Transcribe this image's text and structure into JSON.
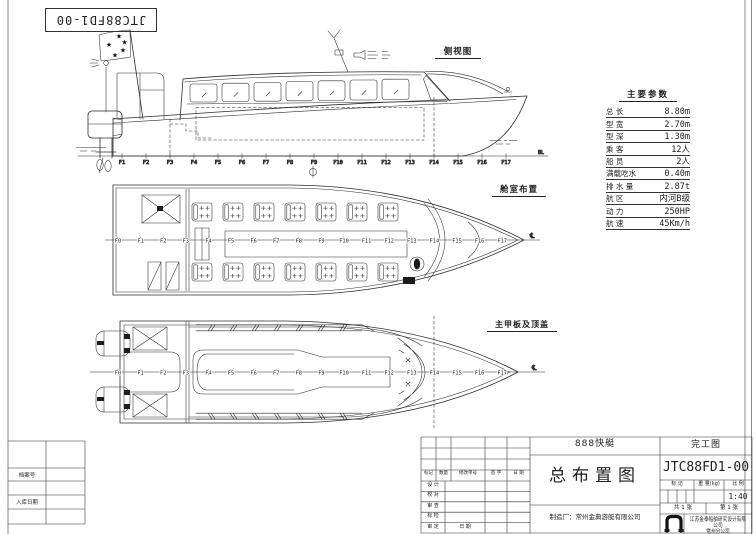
{
  "sheet": {
    "drawing_no_box": "JTC88FD1-00"
  },
  "icons": {
    "flag_star": "★"
  },
  "views": {
    "side_label": "侧视图",
    "cabin_label": "舱室布置",
    "deck_label": "主甲板及顶盖",
    "baseline_mark": "BL",
    "centerline_mark": "℄"
  },
  "frames": {
    "f1_f17": [
      "F1",
      "F2",
      "F3",
      "F4",
      "F5",
      "F6",
      "F7",
      "F8",
      "F9",
      "F10",
      "F11",
      "F12",
      "F13",
      "F14",
      "F15",
      "F16",
      "F17"
    ],
    "f0_f17": [
      "F0",
      "F1",
      "F2",
      "F3",
      "F4",
      "F5",
      "F6",
      "F7",
      "F8",
      "F9",
      "F10",
      "F11",
      "F12",
      "F13",
      "F14",
      "F15",
      "F16",
      "F17"
    ]
  },
  "parameters": {
    "title": "主要参数",
    "rows": [
      {
        "label": "总  长",
        "value": "8.80m"
      },
      {
        "label": "型  宽",
        "value": "2.70m"
      },
      {
        "label": "型  深",
        "value": "1.30m"
      },
      {
        "label": "乘  客",
        "value": "12人"
      },
      {
        "label": "船  员",
        "value": "2人"
      },
      {
        "label": "满载吃水",
        "value": "0.40m"
      },
      {
        "label": "排 水 量",
        "value": "2.87t"
      },
      {
        "label": "航  区",
        "value": "内河B级"
      },
      {
        "label": "动  力",
        "value": "250HP"
      },
      {
        "label": "航  速",
        "value": "45Km/h"
      }
    ]
  },
  "title_block": {
    "product": "888快艇",
    "stage": "完工图",
    "drawing_no": "JTC88FD1-00",
    "drawing_title": "总布置图",
    "manufacturer": "制造厂：常州金典游艇有限公司",
    "company": "江苏金泰船舶研究设计有限公司",
    "branch": "常州分公司",
    "rev_headers": [
      "标记",
      "数量",
      "修改单号",
      "签 字",
      "日 期"
    ],
    "sign_rows": [
      "设 计",
      "校 对",
      "审 查",
      "标 检",
      "审 定"
    ],
    "date_label": "日 期",
    "mark_label": "标 记",
    "weight_label": "重 量(kg)",
    "scale_label": "比 例",
    "scale_value": "1:40",
    "sheets_total": "共 1 张",
    "sheet_no": "第 1 张"
  },
  "corner": {
    "archive_label": "档案号",
    "inbound_label": "入库日期"
  }
}
